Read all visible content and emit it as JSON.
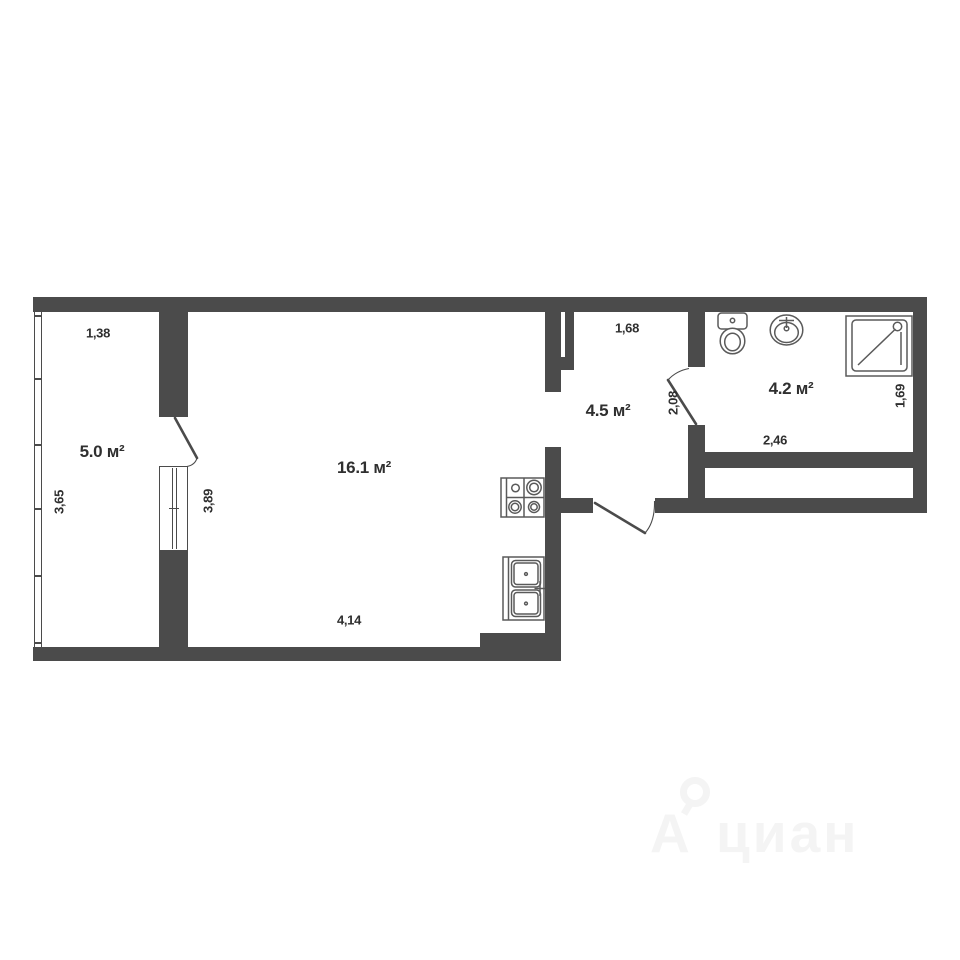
{
  "plan": {
    "type": "apartment-floor-plan",
    "rooms": [
      {
        "id": "room-5",
        "area_label": "5.0 м²"
      },
      {
        "id": "room-16",
        "area_label": "16.1 м²"
      },
      {
        "id": "hall-45",
        "area_label": "4.5 м²"
      },
      {
        "id": "bath-42",
        "area_label": "4.2 м²"
      }
    ],
    "dimensions": {
      "room5_top": "1,38",
      "room5_left": "3,65",
      "room5_door_wall": "3,89",
      "room16_bottom": "4,14",
      "hall_top": "1,68",
      "hall_door_wall": "2,08",
      "bath_bottom": "2,46",
      "bath_right": "1,69"
    },
    "fixtures": [
      "stove",
      "kitchen-sink",
      "toilet",
      "bathroom-sink",
      "shower"
    ]
  },
  "watermark": {
    "logo_letter": "А",
    "text": "циан"
  },
  "colors": {
    "background": "#ffffff",
    "wall": "#4b4b4b",
    "fixture_stroke": "#5a5a5a",
    "label_text": "#2f2f2f",
    "watermark": "#f4f4f4"
  }
}
